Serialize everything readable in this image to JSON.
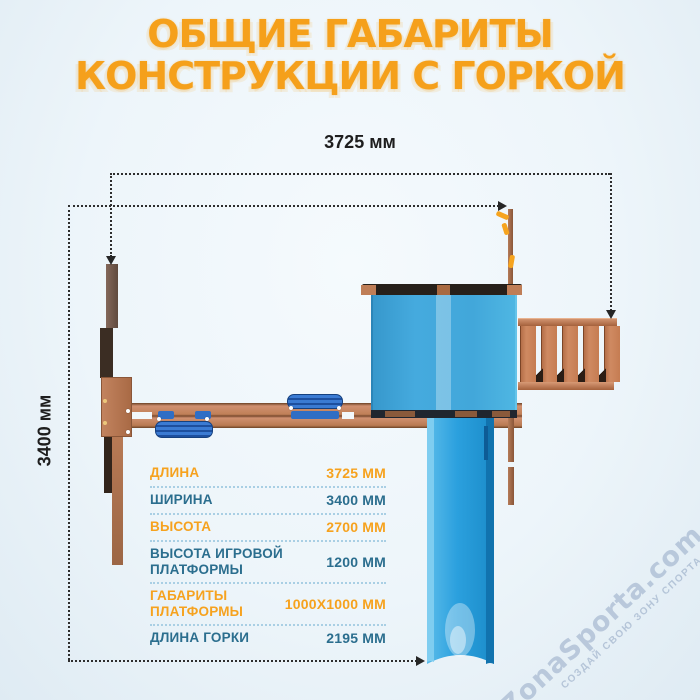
{
  "title": {
    "line1": "ОБЩИЕ ГАБАРИТЫ",
    "line2": "КОНСТРУКЦИИ С ГОРКОЙ"
  },
  "dimensions": {
    "total_length_label": "3725 мм",
    "total_width_label": "3400 мм"
  },
  "spec_table": {
    "rows": [
      {
        "label": "ДЛИНА",
        "value": "3725 ММ"
      },
      {
        "label": "ШИРИНА",
        "value": "3400 ММ"
      },
      {
        "label": "ВЫСОТА",
        "value": "2700 ММ"
      },
      {
        "label": "ВЫСОТА ИГРОВОЙ\nПЛАТФОРМЫ",
        "value": "1200 ММ"
      },
      {
        "label": "ГАБАРИТЫ\nПЛАТФОРМЫ",
        "value": "1000X1000 ММ"
      },
      {
        "label": "ДЛИНА ГОРКИ",
        "value": "2195 ММ"
      }
    ]
  },
  "watermark": {
    "brand": "ZonaSporta.com",
    "tagline": "СОЗДАЙ СВОЮ ЗОНУ СПОРТА"
  },
  "colors": {
    "accent_orange": "#F6A21E",
    "accent_teal": "#2B6E8E",
    "canopy_blue": "#42A7DA",
    "slide_blue": "#2BA0DE",
    "swing_blue": "#2F6EC5",
    "wood_brown": "#C08058",
    "dimension_line": "#2E2E2E",
    "background": "#EDF5FA"
  }
}
